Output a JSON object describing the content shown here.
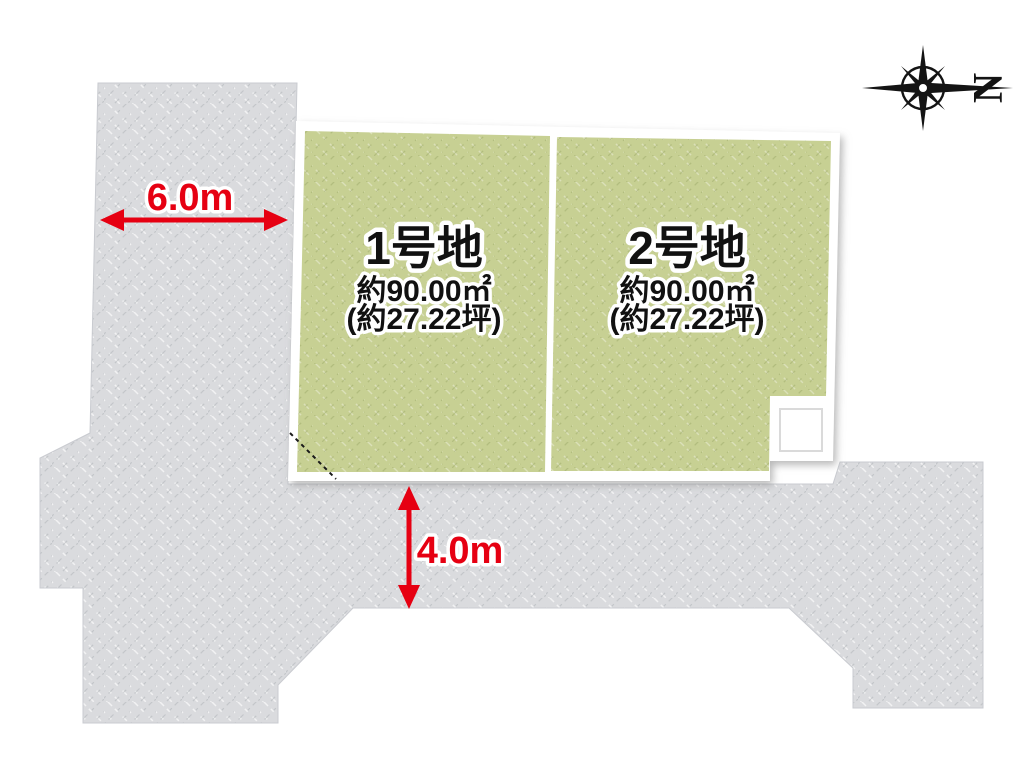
{
  "plots": [
    {
      "name": "1号地",
      "area_m2": "約90.00㎡",
      "area_tsubo": "(約27.22坪)"
    },
    {
      "name": "2号地",
      "area_m2": "約90.00㎡",
      "area_tsubo": "(約27.22坪)"
    }
  ],
  "dimensions": {
    "west_road": {
      "label": "6.0m",
      "orientation": "horizontal"
    },
    "south_road": {
      "label": "4.0m",
      "orientation": "vertical"
    }
  },
  "compass": {
    "label": "N",
    "points": "right"
  },
  "colors": {
    "road": "#dadbde",
    "grass": "#c7d093",
    "dimension_accent": "#e60012",
    "plot_border": "#ffffff",
    "label_text": "#111111",
    "compass": "#141414"
  }
}
